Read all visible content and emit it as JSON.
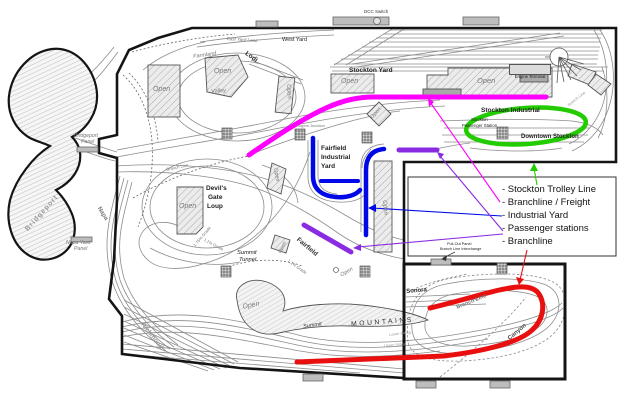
{
  "diagram_title": "Model railroad layout track plan",
  "legend": {
    "items": [
      {
        "label": "- Stockton Trolley Line",
        "color": "#22cc00"
      },
      {
        "label": "- Branchline / Freight",
        "color": "#ff00ff"
      },
      {
        "label": "- Industrial Yard",
        "color": "#0008e8"
      },
      {
        "label": "- Passenger stations",
        "color": "#8a2be2"
      },
      {
        "label": "- Branchline",
        "color": "#e90f0f"
      }
    ]
  },
  "labels": {
    "open": "Open",
    "dcc_switch": "DCC Switch",
    "east_yard_lead": "East Yard Lead",
    "west_yard": "West Yard",
    "lodi": "Lodi",
    "farmland": "Farmland",
    "valley": "Valley",
    "stockton_yard": "Stockton Yard",
    "engine_terminal": "Engine Terminal",
    "branch_line": "Branch Line",
    "stockton_industrial": "Stockton Industrial",
    "sps_line1": "Stockton",
    "sps_line2": "Passenger Station",
    "downtown_stockton": "Downtown Stockton",
    "rogers_junction": "Rogers Junction",
    "fairfield_yard_line1": "Fairfield",
    "fairfield_yard_line2": "Industrial",
    "fairfield_yard_line3": "Yard",
    "devils_line1": "Devil's",
    "devils_line2": "Gate",
    "devils_line3": "Loup",
    "grade_175": "1.75% Grade",
    "grade_11": "1.1% Grade",
    "bridgeport": "Bridgeport",
    "bridgeport_panel_line1": "Bridgeport",
    "bridgeport_panel_line2": "Panel",
    "napa": "Napa",
    "napa_yard_panel_line1": "Napa Yard",
    "napa_yard_panel_line2": "Panel",
    "richmond": "Richmond",
    "summit_tunnel_line1": "Summit",
    "summit_tunnel_line2": "Tunnel",
    "fairfield": "Fairfield",
    "summit": "Summit",
    "mountains": "MOUNTAINS",
    "lower_siding": "Lower Siding",
    "upper_siding": "Upper Siding",
    "sonora": "Sonora",
    "canyon": "Canyon",
    "pull_out_line1": "Pull-Out Panel",
    "pull_out_line2": "Branch Line Interchange"
  },
  "highlight_colors": {
    "stockton_trolley_line": "#22cc00",
    "branchline_freight": "#ff00ff",
    "industrial_yard": "#0008e8",
    "passenger_stations": "#8a2be2",
    "branchline": "#e90f0f"
  }
}
